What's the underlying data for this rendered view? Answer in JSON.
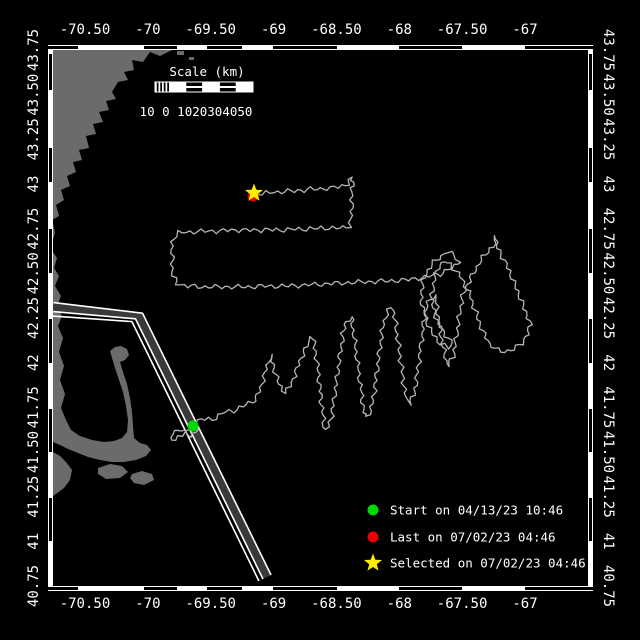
{
  "window": {
    "title": "Glider track map",
    "width": 640,
    "height": 640
  },
  "colors": {
    "background": "#000000",
    "frame": "#ffffff",
    "land": "#6b6b6b",
    "water": "#000000",
    "track": "#b5b5b5",
    "lane_fill": "#3a3a3a",
    "lane_line": "#ffffff",
    "start_marker": "#00d900",
    "last_marker": "#e80000",
    "selected_marker": "#ffee00",
    "text": "#ffffff"
  },
  "axes": {
    "lon_labels": [
      "-70.50",
      "-70",
      "-69.50",
      "-69",
      "-68.50",
      "-68",
      "-67.50",
      "-67"
    ],
    "lon_positions": [
      85,
      147.9,
      210.7,
      273.6,
      336.4,
      399.3,
      462.1,
      525
    ],
    "lat_labels": [
      "43.75",
      "43.50",
      "43.25",
      "43",
      "42.75",
      "42.50",
      "42.25",
      "42",
      "41.75",
      "41.50",
      "41.25",
      "41",
      "40.75"
    ],
    "lat_positions": [
      50,
      94.7,
      139.3,
      184,
      228.7,
      273.3,
      318,
      362.7,
      407.3,
      452,
      496.7,
      541.3,
      586
    ],
    "top_label_y": 34,
    "bottom_label_y": 608,
    "left_label_x": 38,
    "right_label_x": 604
  },
  "frame": {
    "left": 48,
    "right": 593,
    "top": 45,
    "bottom": 591,
    "bar": 5,
    "inner": {
      "x": 53,
      "y": 50,
      "w": 535,
      "h": 536
    },
    "h_black_segs": [
      [
        48,
        78
      ],
      [
        144,
        177
      ],
      [
        207,
        242
      ],
      [
        273,
        337
      ],
      [
        399,
        462
      ],
      [
        525,
        593
      ]
    ],
    "v_black_segs": [
      [
        54,
        90
      ],
      [
        148,
        182
      ],
      [
        229,
        273
      ],
      [
        319,
        363
      ],
      [
        409,
        452
      ],
      [
        498,
        541
      ]
    ]
  },
  "scalebar": {
    "title": "Scale (km)",
    "numbers": "10 0 1020304050",
    "title_x": 207,
    "title_y": 76,
    "numbers_x": 196,
    "numbers_y": 116,
    "bar": {
      "x": 155,
      "y": 82,
      "w": 98,
      "h": 10,
      "hatch_w": 14,
      "seg_w": 16.8
    }
  },
  "legend": {
    "marker_x": 373,
    "text_x": 390,
    "row_ys": [
      510,
      537,
      563
    ],
    "items": [
      {
        "marker": "circle",
        "color": "#00d900",
        "label": "Start on 04/13/23 10:46"
      },
      {
        "marker": "circle",
        "color": "#e80000",
        "label": "Last on 07/02/23 04:46"
      },
      {
        "marker": "star",
        "color": "#ffee00",
        "label": "Selected on 07/02/23 04:46"
      }
    ]
  },
  "markers": {
    "start": {
      "x": 193,
      "y": 426,
      "type": "circle",
      "color": "#00d900",
      "r": 5.5
    },
    "last": {
      "x": 253,
      "y": 196,
      "type": "circle",
      "color": "#e80000",
      "r": 5.5
    },
    "selected": {
      "x": 254,
      "y": 193,
      "type": "star",
      "color": "#ffee00",
      "r": 9.5
    }
  },
  "geometry": {
    "land_polygons": [
      [
        [
          53,
          50
        ],
        [
          172,
          50
        ],
        [
          160,
          56
        ],
        [
          150,
          52
        ],
        [
          143,
          62
        ],
        [
          132,
          60
        ],
        [
          134,
          70
        ],
        [
          124,
          72
        ],
        [
          128,
          80
        ],
        [
          118,
          82
        ],
        [
          112,
          92
        ],
        [
          116,
          99
        ],
        [
          106,
          101
        ],
        [
          109,
          110
        ],
        [
          99,
          112
        ],
        [
          103,
          122
        ],
        [
          93,
          124
        ],
        [
          96,
          134
        ],
        [
          86,
          136
        ],
        [
          89,
          148
        ],
        [
          79,
          150
        ],
        [
          82,
          160
        ],
        [
          73,
          162
        ],
        [
          76,
          172
        ],
        [
          67,
          176
        ],
        [
          70,
          186
        ],
        [
          61,
          190
        ],
        [
          64,
          200
        ],
        [
          56,
          205
        ],
        [
          59,
          216
        ],
        [
          52,
          220
        ],
        [
          55,
          232
        ],
        [
          53,
          240
        ]
      ],
      [
        [
          53,
          252
        ],
        [
          57,
          258
        ],
        [
          54,
          268
        ],
        [
          59,
          276
        ],
        [
          55,
          286
        ],
        [
          61,
          296
        ],
        [
          57,
          306
        ],
        [
          62,
          316
        ],
        [
          58,
          326
        ],
        [
          63,
          338
        ],
        [
          59,
          352
        ],
        [
          64,
          366
        ],
        [
          60,
          380
        ],
        [
          65,
          394
        ],
        [
          61,
          408
        ],
        [
          66,
          420
        ],
        [
          71,
          430
        ],
        [
          80,
          436
        ],
        [
          92,
          440
        ],
        [
          104,
          442
        ],
        [
          114,
          441
        ],
        [
          122,
          438
        ],
        [
          127,
          432
        ],
        [
          128,
          420
        ],
        [
          126,
          406
        ],
        [
          123,
          392
        ],
        [
          119,
          380
        ],
        [
          115,
          368
        ],
        [
          112,
          358
        ],
        [
          110,
          351
        ],
        [
          115,
          347
        ],
        [
          121,
          346
        ],
        [
          127,
          349
        ],
        [
          129,
          355
        ],
        [
          125,
          360
        ],
        [
          120,
          362
        ],
        [
          123,
          372
        ],
        [
          127,
          384
        ],
        [
          130,
          398
        ],
        [
          132,
          412
        ],
        [
          133,
          426
        ],
        [
          134,
          438
        ],
        [
          140,
          443
        ],
        [
          147,
          445
        ],
        [
          151,
          450
        ],
        [
          146,
          456
        ],
        [
          136,
          460
        ],
        [
          124,
          462
        ],
        [
          112,
          462
        ],
        [
          100,
          460
        ],
        [
          88,
          457
        ],
        [
          78,
          453
        ],
        [
          68,
          449
        ],
        [
          60,
          445
        ],
        [
          53,
          442
        ]
      ],
      [
        [
          98,
          468
        ],
        [
          110,
          464
        ],
        [
          122,
          466
        ],
        [
          128,
          472
        ],
        [
          120,
          478
        ],
        [
          106,
          479
        ],
        [
          98,
          474
        ]
      ],
      [
        [
          132,
          474
        ],
        [
          142,
          471
        ],
        [
          152,
          474
        ],
        [
          154,
          480
        ],
        [
          144,
          485
        ],
        [
          134,
          483
        ],
        [
          130,
          478
        ]
      ],
      [
        [
          53,
          452
        ],
        [
          60,
          456
        ],
        [
          66,
          462
        ],
        [
          72,
          470
        ],
        [
          70,
          480
        ],
        [
          64,
          488
        ],
        [
          56,
          494
        ],
        [
          53,
          496
        ]
      ],
      [
        [
          177,
          51
        ],
        [
          184,
          51
        ],
        [
          184,
          55
        ],
        [
          177,
          55
        ]
      ],
      [
        [
          189,
          57
        ],
        [
          194,
          57
        ],
        [
          194,
          60
        ],
        [
          189,
          60
        ]
      ]
    ],
    "lane": {
      "center": [
        [
          53,
          307
        ],
        [
          139,
          316
        ],
        [
          267,
          577
        ]
      ],
      "band_width": 8,
      "line_offsets": [
        4.5,
        -4.5,
        -9
      ],
      "line_width": 1.6
    },
    "track": {
      "stroke_width": 1.3,
      "wiggle_amp": 2.0,
      "wiggle_len": 11,
      "points": [
        [
          193,
          426
        ],
        [
          185,
          433
        ],
        [
          176,
          440
        ],
        [
          170,
          436
        ],
        [
          178,
          429
        ],
        [
          190,
          436
        ],
        [
          198,
          430
        ],
        [
          192,
          424
        ],
        [
          201,
          419
        ],
        [
          212,
          420
        ],
        [
          222,
          413
        ],
        [
          233,
          411
        ],
        [
          243,
          406
        ],
        [
          252,
          402
        ],
        [
          258,
          395
        ],
        [
          262,
          384
        ],
        [
          266,
          369
        ],
        [
          270,
          355
        ],
        [
          274,
          368
        ],
        [
          279,
          384
        ],
        [
          285,
          393
        ],
        [
          290,
          386
        ],
        [
          296,
          372
        ],
        [
          301,
          358
        ],
        [
          307,
          346
        ],
        [
          312,
          336
        ],
        [
          315,
          348
        ],
        [
          318,
          368
        ],
        [
          320,
          388
        ],
        [
          322,
          408
        ],
        [
          324,
          426
        ],
        [
          327,
          430
        ],
        [
          331,
          419
        ],
        [
          334,
          399
        ],
        [
          337,
          377
        ],
        [
          340,
          354
        ],
        [
          343,
          334
        ],
        [
          346,
          322
        ],
        [
          351,
          317
        ],
        [
          353,
          330
        ],
        [
          356,
          352
        ],
        [
          359,
          374
        ],
        [
          362,
          396
        ],
        [
          364,
          412
        ],
        [
          367,
          417
        ],
        [
          372,
          407
        ],
        [
          375,
          387
        ],
        [
          378,
          364
        ],
        [
          381,
          341
        ],
        [
          384,
          321
        ],
        [
          388,
          311
        ],
        [
          393,
          307
        ],
        [
          395,
          320
        ],
        [
          398,
          342
        ],
        [
          401,
          364
        ],
        [
          404,
          386
        ],
        [
          406,
          400
        ],
        [
          409,
          404
        ],
        [
          414,
          395
        ],
        [
          417,
          375
        ],
        [
          420,
          351
        ],
        [
          423,
          329
        ],
        [
          426,
          309
        ],
        [
          430,
          299
        ],
        [
          435,
          295
        ],
        [
          437,
          307
        ],
        [
          440,
          327
        ],
        [
          443,
          347
        ],
        [
          446,
          361
        ],
        [
          448,
          366
        ],
        [
          453,
          357
        ],
        [
          456,
          339
        ],
        [
          459,
          317
        ],
        [
          462,
          299
        ],
        [
          466,
          287
        ],
        [
          471,
          278
        ],
        [
          477,
          267
        ],
        [
          483,
          257
        ],
        [
          490,
          249
        ],
        [
          496,
          244
        ],
        [
          497,
          236
        ],
        [
          496,
          245
        ],
        [
          501,
          254
        ],
        [
          506,
          264
        ],
        [
          511,
          275
        ],
        [
          515,
          285
        ],
        [
          519,
          295
        ],
        [
          523,
          305
        ],
        [
          527,
          315
        ],
        [
          530,
          324
        ],
        [
          528,
          334
        ],
        [
          522,
          343
        ],
        [
          514,
          349
        ],
        [
          505,
          352
        ],
        [
          497,
          350
        ],
        [
          490,
          344
        ],
        [
          484,
          334
        ],
        [
          479,
          322
        ],
        [
          475,
          310
        ],
        [
          471,
          298
        ],
        [
          467,
          289
        ],
        [
          462,
          279
        ],
        [
          456,
          271
        ],
        [
          450,
          265
        ],
        [
          444,
          261
        ],
        [
          438,
          268
        ],
        [
          434,
          280
        ],
        [
          432,
          294
        ],
        [
          433,
          308
        ],
        [
          437,
          320
        ],
        [
          442,
          330
        ],
        [
          448,
          338
        ],
        [
          453,
          344
        ],
        [
          449,
          348
        ],
        [
          441,
          344
        ],
        [
          433,
          335
        ],
        [
          427,
          322
        ],
        [
          423,
          308
        ],
        [
          421,
          294
        ],
        [
          423,
          281
        ],
        [
          428,
          270
        ],
        [
          434,
          262
        ],
        [
          441,
          256
        ],
        [
          448,
          252
        ],
        [
          455,
          255
        ],
        [
          459,
          261
        ],
        [
          455,
          266
        ],
        [
          448,
          270
        ],
        [
          440,
          274
        ],
        [
          425,
          277
        ],
        [
          405,
          280
        ],
        [
          385,
          281
        ],
        [
          365,
          282
        ],
        [
          345,
          283
        ],
        [
          325,
          284
        ],
        [
          305,
          285
        ],
        [
          285,
          286
        ],
        [
          265,
          286
        ],
        [
          245,
          287
        ],
        [
          225,
          287
        ],
        [
          205,
          287
        ],
        [
          188,
          286
        ],
        [
          177,
          284
        ],
        [
          173,
          276
        ],
        [
          172,
          264
        ],
        [
          172,
          250
        ],
        [
          173,
          238
        ],
        [
          178,
          233
        ],
        [
          190,
          232
        ],
        [
          205,
          231
        ],
        [
          220,
          231
        ],
        [
          235,
          230
        ],
        [
          250,
          230
        ],
        [
          265,
          230
        ],
        [
          280,
          230
        ],
        [
          295,
          229
        ],
        [
          310,
          229
        ],
        [
          325,
          228
        ],
        [
          340,
          228
        ],
        [
          349,
          227
        ],
        [
          351,
          219
        ],
        [
          352,
          208
        ],
        [
          352,
          196
        ],
        [
          351,
          188
        ],
        [
          354,
          182
        ],
        [
          352,
          177
        ],
        [
          349,
          184
        ],
        [
          342,
          186
        ],
        [
          330,
          188
        ],
        [
          317,
          189
        ],
        [
          304,
          190
        ],
        [
          291,
          191
        ],
        [
          278,
          192
        ],
        [
          266,
          193
        ],
        [
          254,
          194
        ]
      ]
    }
  }
}
